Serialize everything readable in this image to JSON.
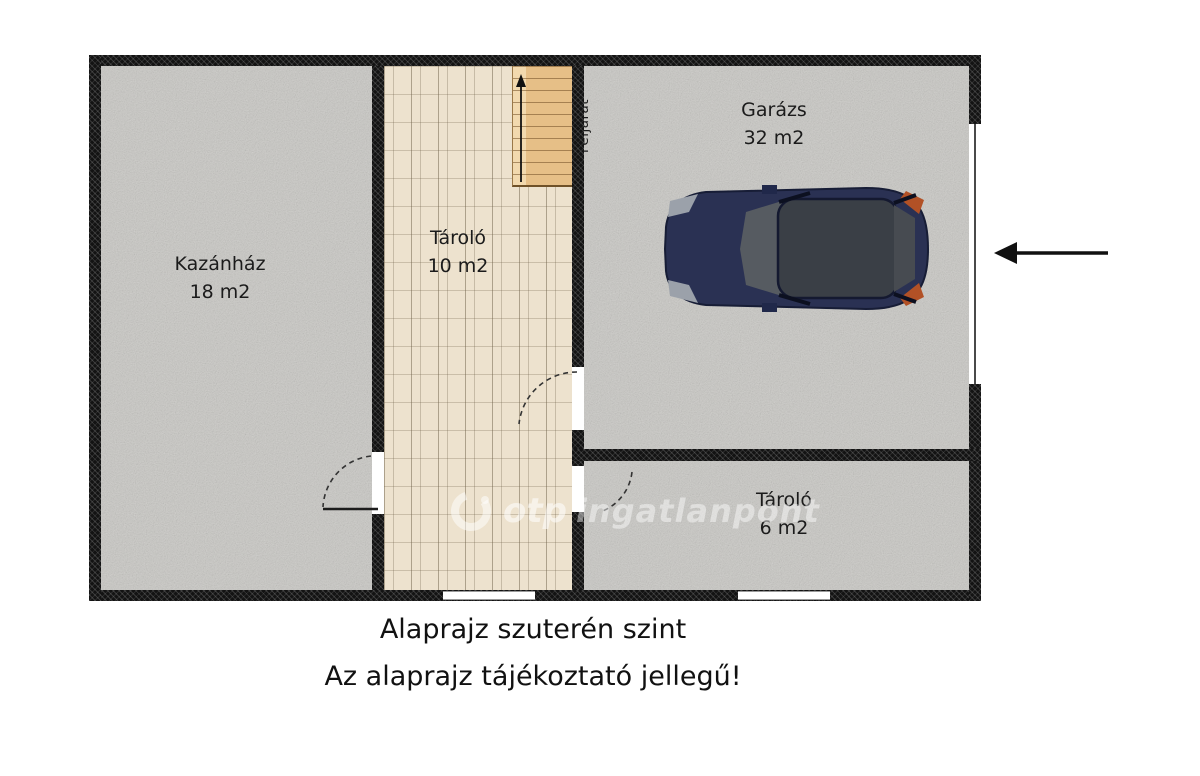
{
  "plan": {
    "rooms": [
      {
        "name": "Kazánház",
        "area": "18 m2"
      },
      {
        "name": "Tároló",
        "area": "10 m2"
      },
      {
        "name": "Garázs",
        "area": "32 m2"
      },
      {
        "name": "Tároló",
        "area": "6 m2"
      }
    ],
    "stairs": {
      "label": "Feljárat"
    }
  },
  "watermark": {
    "brand": "otp",
    "name": "ingatlanpont"
  },
  "captions": {
    "line1": "Alaprajz szuterén szint",
    "line2": "Az alaprajz tájékoztató jellegű!"
  },
  "colors": {
    "wall": "#131313",
    "floor_gray": "#c9c8c4",
    "floor_wood": "#ede2ce",
    "stairs": "#e6bf87",
    "car_body": "#2a3153",
    "arrow": "#111111"
  }
}
